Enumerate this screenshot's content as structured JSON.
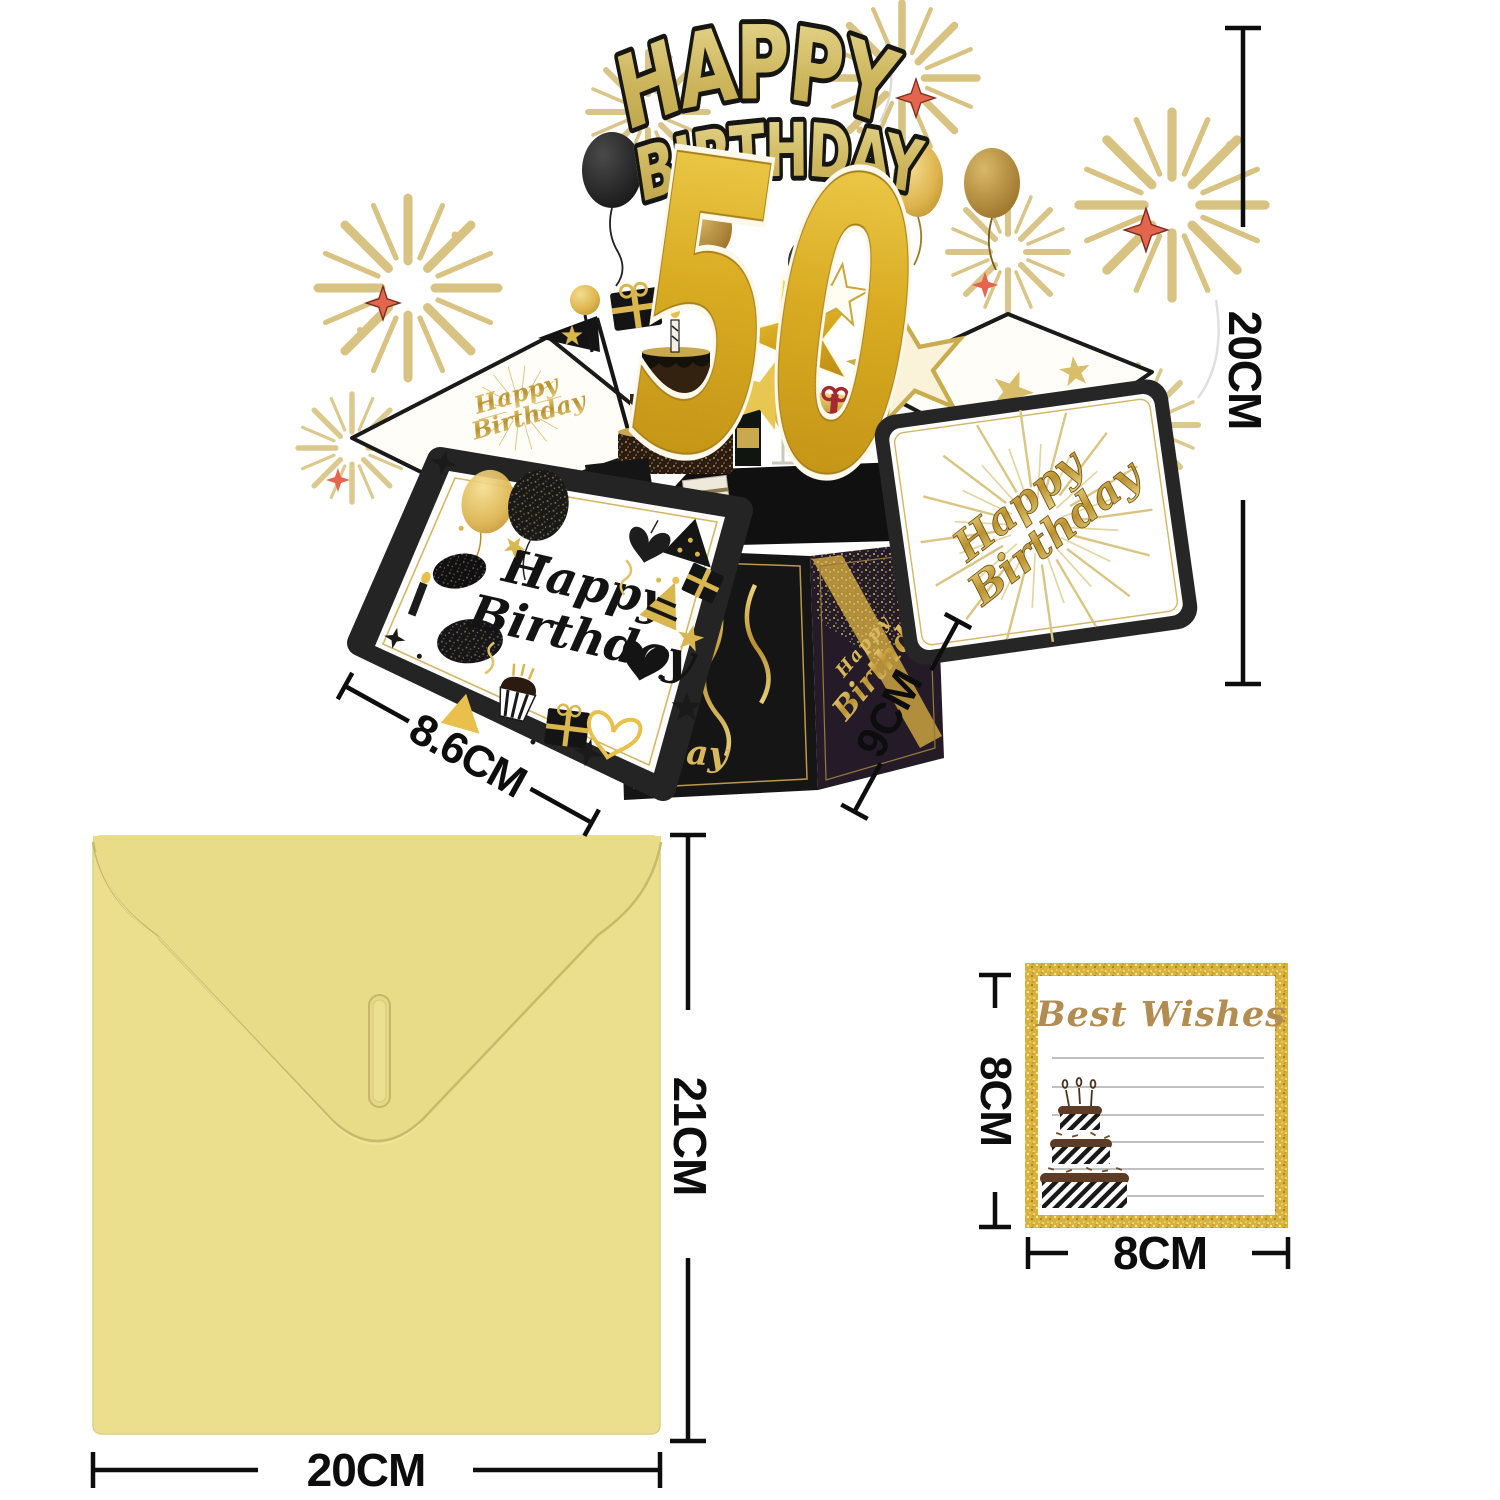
{
  "popup_card": {
    "title_line1": "HAPPY",
    "title_line2": "BIRTHDAY",
    "age_number": "50",
    "left_panel_script_line1": "Happy",
    "left_panel_script_line2": "Birthday",
    "right_panel_script_line1": "Happy",
    "right_panel_script_line2": "Birthday",
    "back_flap_script_line1": "Happy",
    "back_flap_script_line2": "Birthday",
    "box_right_face_line1": "Happy",
    "box_right_face_line2": "Birthday",
    "box_left_face_partial": "day"
  },
  "annotations": {
    "popup_height": "20CM",
    "popup_flap_width": "8.6CM",
    "popup_box_depth": "9CM",
    "envelope_height": "21CM",
    "envelope_width": "20CM",
    "note_height": "8CM",
    "note_width": "8CM"
  },
  "note_card": {
    "title": "Best Wishes"
  },
  "colors": {
    "glitter_gold": "#d9b74e",
    "pale_firework_gold": "#dcc98e",
    "bright_gold_50": "#e3b41f",
    "black": "#171717",
    "box_face_purple": "#251b28",
    "envelope_yellow": "#ebdf8e",
    "firework_star_red": "#e4654e",
    "note_title_gold": "#b28c50"
  }
}
